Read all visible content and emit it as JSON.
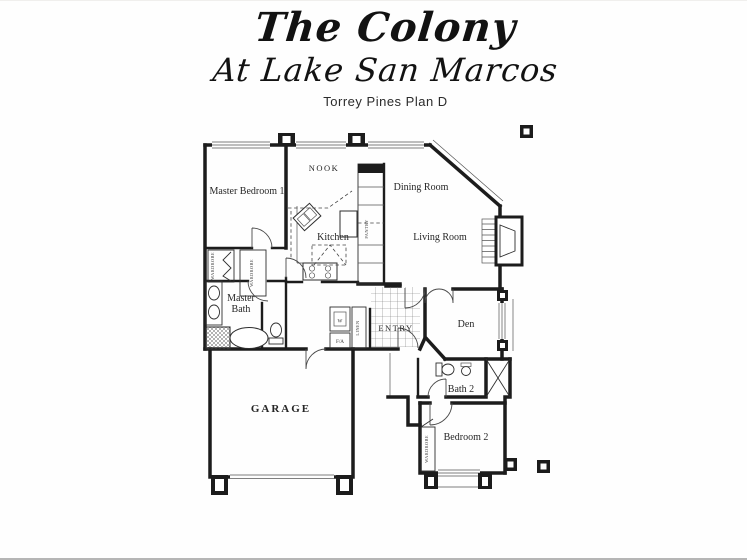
{
  "header": {
    "title": "The Colony",
    "subtitle": "At Lake San Marcos",
    "plan_name": "Torrey Pines Plan D"
  },
  "floor_plan": {
    "rooms": {
      "master_bedroom": "Master Bedroom  1",
      "nook": "NOOK",
      "dining_room": "Dining Room",
      "living_room": "Living Room",
      "kitchen": "Kitchen",
      "master_bath_1": "Master",
      "master_bath_2": "Bath",
      "entry": "ENTRY",
      "den": "Den",
      "garage": "GARAGE",
      "bath2": "Bath 2",
      "bedroom2": "Bedroom 2"
    },
    "small_labels": {
      "wardrobe_master_1": "WARDROBE",
      "wardrobe_master_2": "WARDROBE",
      "wardrobe_bedroom2": "WARDROBE",
      "linen": "LINEN",
      "pantry": "PANTRY",
      "water_heater": "W",
      "forced_air": "F/A"
    },
    "colors": {
      "line": "#1c1c1c",
      "background": "#fefefe"
    }
  }
}
